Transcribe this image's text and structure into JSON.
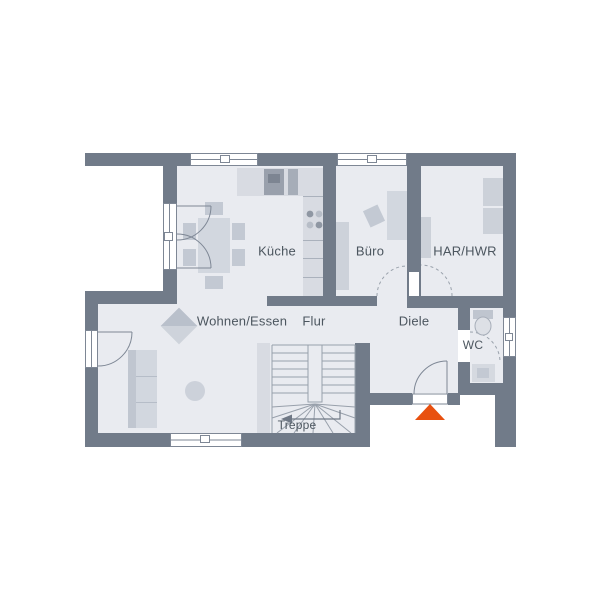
{
  "plan": {
    "type": "residential-floor-plan",
    "rooms": {
      "kueche": {
        "label": "Küche"
      },
      "buero": {
        "label": "Büro"
      },
      "har_hwr": {
        "label": "HAR/HWR"
      },
      "wohnen_essen": {
        "label": "Wohnen/Essen"
      },
      "flur": {
        "label": "Flur"
      },
      "diele": {
        "label": "Diele"
      },
      "wc": {
        "label": "WC"
      },
      "treppe": {
        "label": "Treppe"
      }
    },
    "markers": {
      "entrance": {
        "shape": "triangle-up",
        "color": "#e8500f",
        "meaning": "main-entrance"
      }
    },
    "colors": {
      "wall": "#717b89",
      "floor": "#e9ebf0",
      "furniture": "#d2d7df",
      "furniture_dark": "#c3c9d3",
      "linework": "#8b93a0",
      "text": "#4c565f",
      "window": "#ffffff",
      "accent": "#e8500f"
    },
    "symbols": [
      "dining-table-with-chairs",
      "sofa",
      "kitchen-counter",
      "cooktop",
      "desk",
      "office-chair",
      "washer-dryer",
      "toilet",
      "sink",
      "winder-staircase",
      "stair-direction-arrow",
      "door-swing-arcs",
      "window-glazing",
      "entrance-marker"
    ]
  }
}
